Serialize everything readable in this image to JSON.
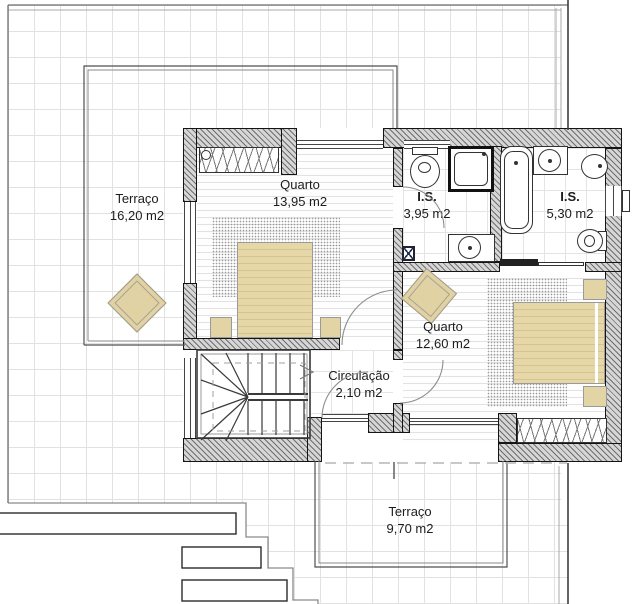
{
  "plan": {
    "rooms": [
      {
        "id": "terraco1",
        "name": "Terraço",
        "area": "16,20 m2"
      },
      {
        "id": "quarto1",
        "name": "Quarto",
        "area": "13,95 m2"
      },
      {
        "id": "is1",
        "name": "I.S.",
        "area": "3,95 m2"
      },
      {
        "id": "is2",
        "name": "I.S.",
        "area": "5,30 m2"
      },
      {
        "id": "quarto2",
        "name": "Quarto",
        "area": "12,60 m2"
      },
      {
        "id": "circulacao",
        "name": "Circulação",
        "area": "2,10 m2"
      },
      {
        "id": "terraco2",
        "name": "Terraço",
        "area": "9,70 m2"
      }
    ],
    "fixtures": [
      "wardrobe",
      "bed",
      "rug",
      "bedside-table",
      "lounge-chair",
      "toilet",
      "shower",
      "washbasin",
      "bathtub",
      "bidet",
      "stairs",
      "sliding-door"
    ],
    "colors": {
      "furniture": "#e2d4a4",
      "furniture_stripe": "#d7c48d",
      "wall_fill": "#d6d6d6",
      "wall_hatch": "#6f6f6f",
      "tile_grid": "#e1e1e1",
      "boundary": "#777777",
      "linework": "#333333"
    }
  }
}
